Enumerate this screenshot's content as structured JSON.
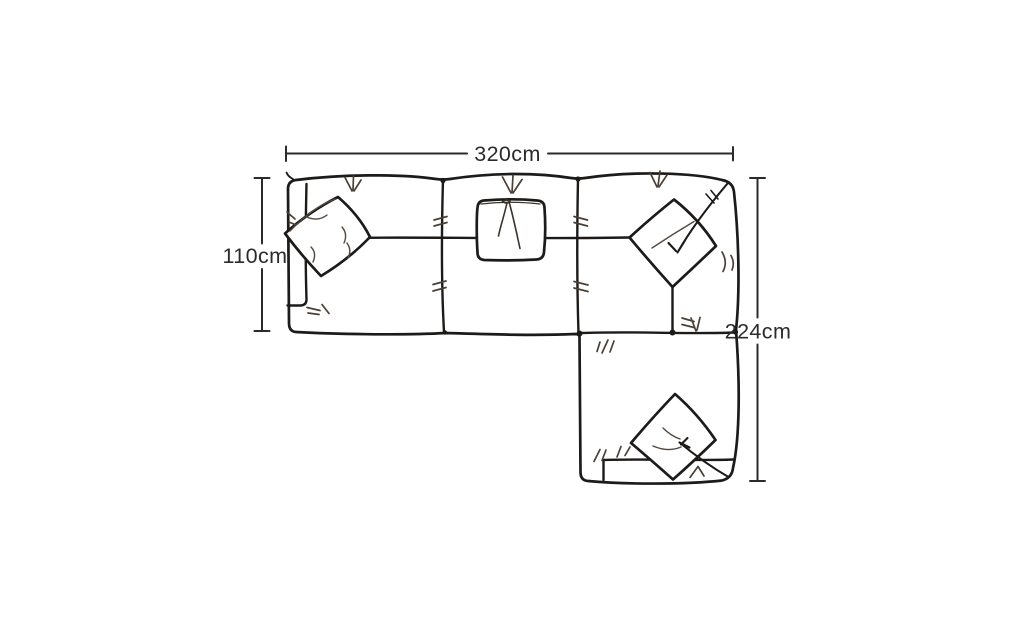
{
  "diagram": {
    "dimensions": {
      "width_top": "320cm",
      "depth_left": "110cm",
      "length_right": "224cm"
    },
    "colors": {
      "background": "#ffffff",
      "line": "#1d1b19",
      "dimension": "#2b2b2b",
      "tuft": "#4a4036"
    }
  }
}
